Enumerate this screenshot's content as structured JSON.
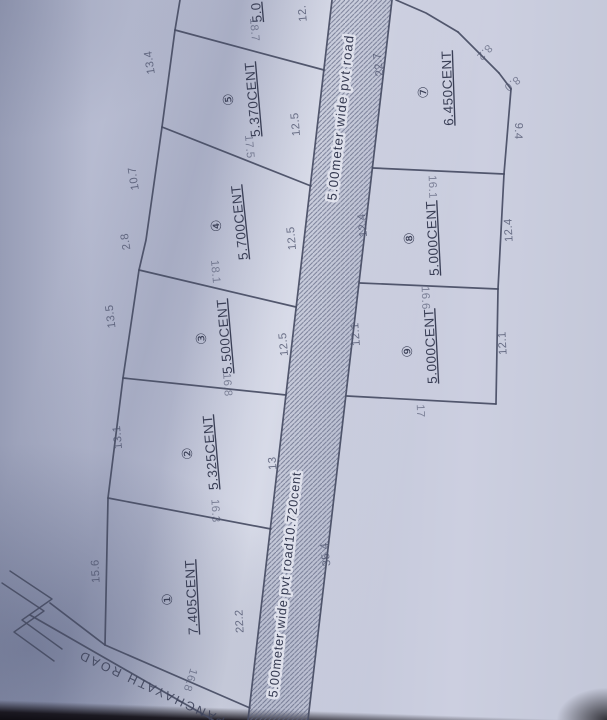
{
  "paper_color": "#bfc3d6",
  "ink_color": "#3d4259",
  "plots": [
    {
      "no": "①",
      "area": "7.405CENT"
    },
    {
      "no": "②",
      "area": "5.325CENT"
    },
    {
      "no": "③",
      "area": "5.500CENT"
    },
    {
      "no": "④",
      "area": "5.700CENT"
    },
    {
      "no": "⑤",
      "area": "5.370CENT"
    },
    {
      "no": "",
      "area": "5.0"
    },
    {
      "no": "⑦",
      "area": "6.450CENT"
    },
    {
      "no": "⑧",
      "area": "5.000CENT"
    },
    {
      "no": "⑨",
      "area": "5.000CENT"
    }
  ],
  "roads": {
    "pvt_upper": "5.00meter wide pvt road",
    "pvt_lower": "5.00meter wide pvt road10.720cent",
    "panchayath": "PANCHAYATH ROAD"
  },
  "dims": {
    "plot6_right_partial": "12.",
    "gap_5_6": "18.7",
    "plot5_outer": "13.4",
    "plot5_right": "12.5",
    "gap_4_5": "17.5",
    "plot4_outer_a": "10.7",
    "plot4_outer_b": "2.8",
    "plot4_right": "12.5",
    "gap_3_4": "18.1",
    "plot3_outer": "13.5",
    "plot3_right": "12.5",
    "gap_2_3": "16.8",
    "plot2_outer": "13.1",
    "plot2_right": "13",
    "gap_1_2": "16.3",
    "plot1_outer": "15.6",
    "plot1_right": "22.2",
    "plot1_bottom": "16.8",
    "road_right_side": "35.4",
    "plot7_top": "22.7",
    "plot7_ne_a": "8.2",
    "plot7_ne_b": "8.0",
    "plot7_right": "9.4",
    "gap_7_8": "16.1",
    "plot8_left": "12.4",
    "plot8_right": "12.4",
    "gap_8_9": "16.6",
    "plot9_left": "12.1",
    "plot9_right": "12.1",
    "plot9_bottom": "17"
  }
}
